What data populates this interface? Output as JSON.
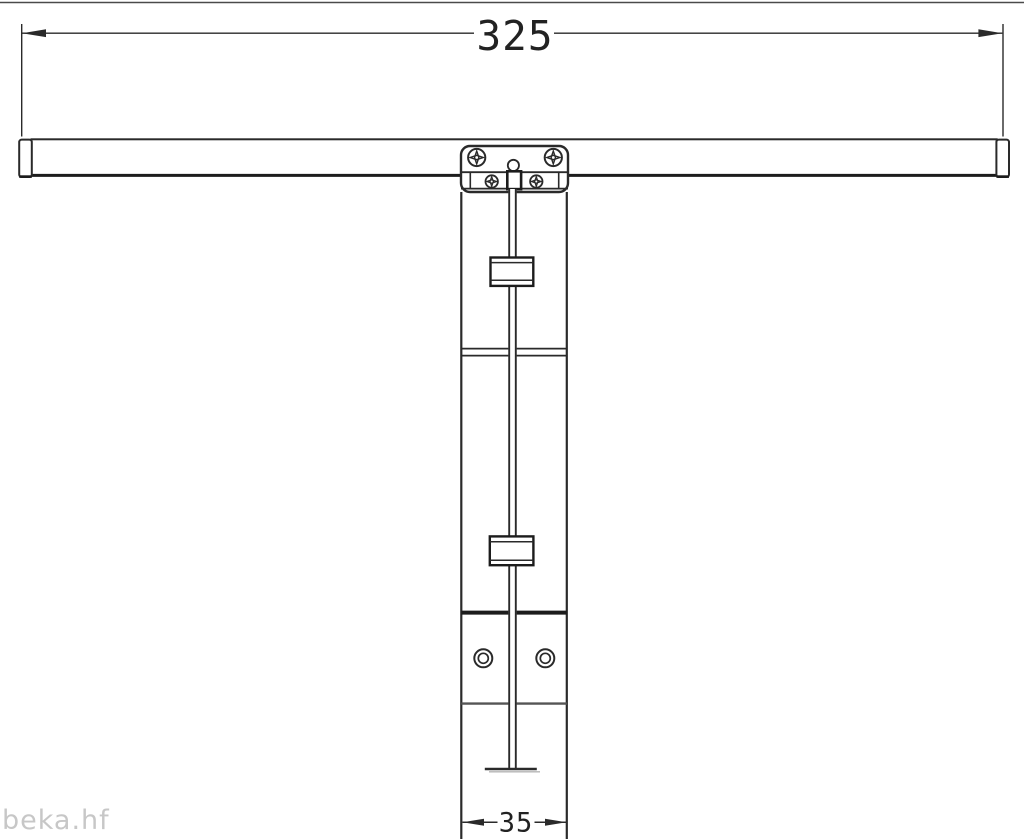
{
  "drawing": {
    "type": "technical-drawing",
    "dimensions": {
      "overall_width": "325",
      "base_width": "35"
    },
    "watermark": "beka.hf",
    "colors": {
      "line": "#2a2a2a",
      "thick_edge": "#1c1c1c",
      "seam_gray": "#555555",
      "background": "#ffffff",
      "dimension_text": "#222222",
      "watermark_text": "#c7c7c7"
    },
    "components": [
      "crossbar",
      "crossbar-end-caps",
      "mounting-bracket",
      "phillips-screws",
      "vertical-mast-channel",
      "center-rod",
      "rod-clamp-blocks",
      "mounting-holes",
      "rod-foot"
    ]
  }
}
